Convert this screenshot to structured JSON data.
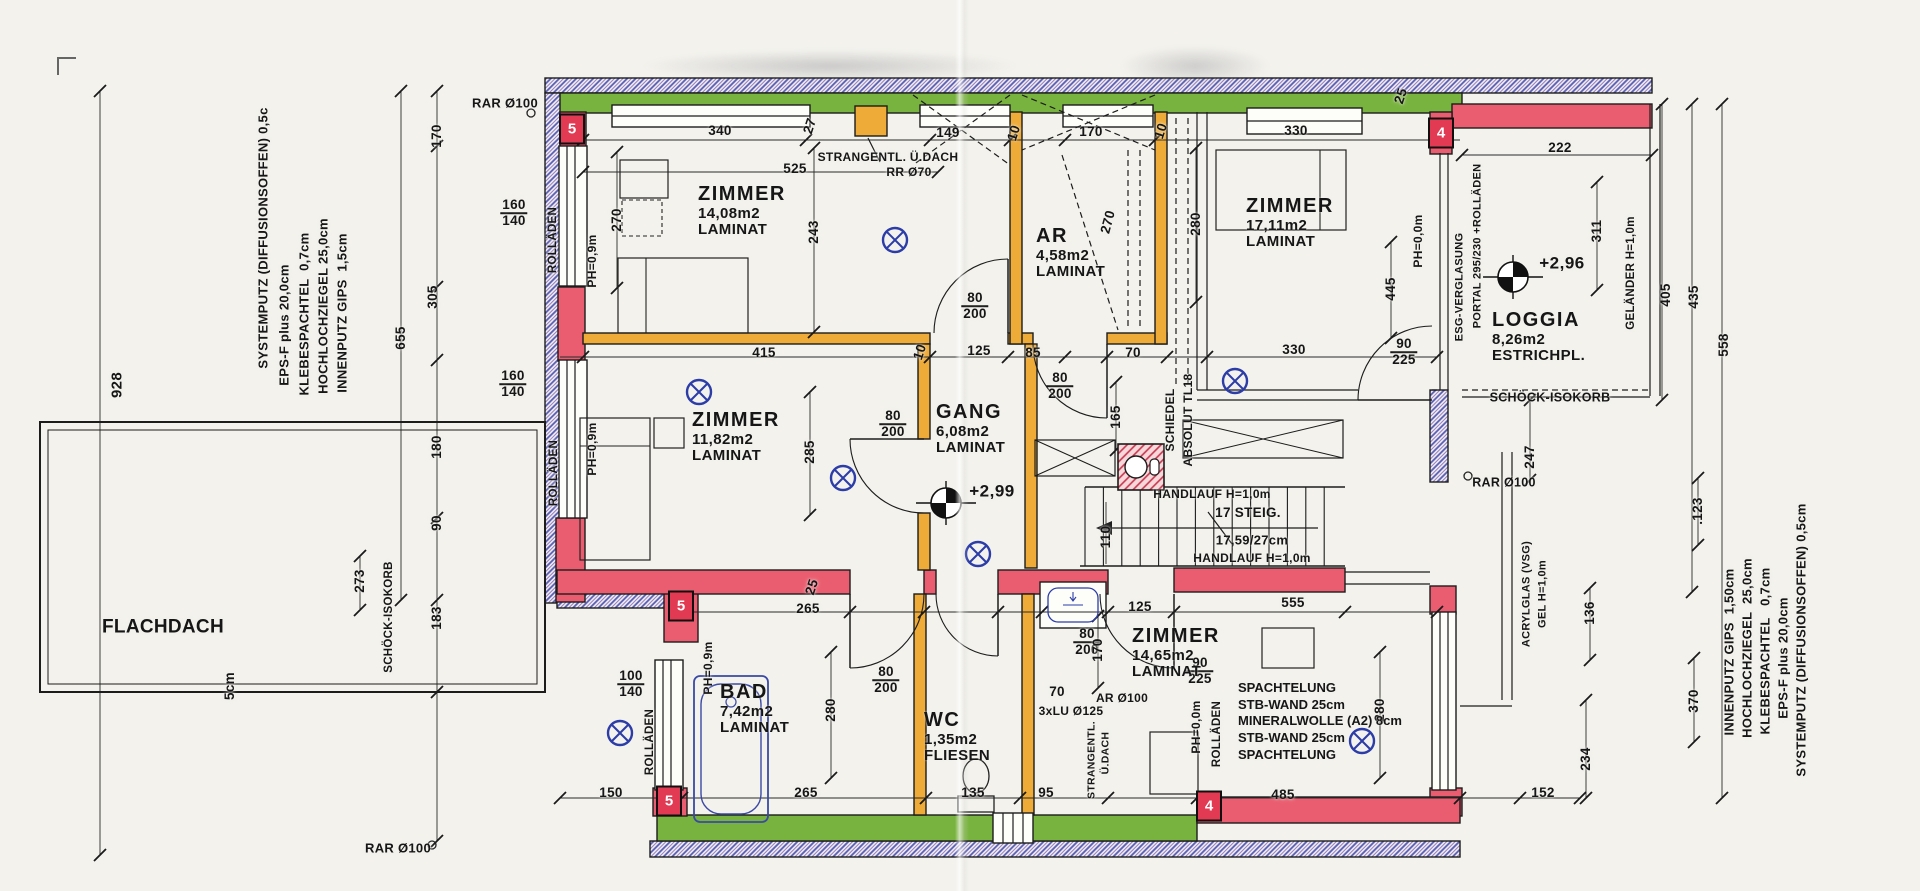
{
  "colors": {
    "paper": "#f3f2ed",
    "exterior_insulation_green": "#79b33f",
    "load_wall_red": "#ea5d70",
    "interior_wall_yellow": "#eeab38",
    "rollladen_hatch_blue": "#5b5bb0",
    "fixture_blue": "#2c3da8",
    "ink": "#161616"
  },
  "rooms": [
    {
      "id": "zimmer-nw",
      "name": "ZIMMER",
      "area": "14,08m2",
      "floor": "LAMINAT",
      "x": 698,
      "y": 184
    },
    {
      "id": "ar",
      "name": "AR",
      "area": "4,58m2",
      "floor": "LAMINAT",
      "x": 1036,
      "y": 226
    },
    {
      "id": "zimmer-ne",
      "name": "ZIMMER",
      "area": "17,11m2",
      "floor": "LAMINAT",
      "x": 1246,
      "y": 196
    },
    {
      "id": "loggia",
      "name": "LOGGIA",
      "area": "8,26m2",
      "floor": "ESTRICHPL.",
      "x": 1492,
      "y": 310
    },
    {
      "id": "zimmer-w",
      "name": "ZIMMER",
      "area": "11,82m2",
      "floor": "LAMINAT",
      "x": 692,
      "y": 410
    },
    {
      "id": "gang",
      "name": "GANG",
      "area": "6,08m2",
      "floor": "LAMINAT",
      "x": 936,
      "y": 402
    },
    {
      "id": "bad",
      "name": "BAD",
      "area": "7,42m2",
      "floor": "LAMINAT",
      "x": 720,
      "y": 682
    },
    {
      "id": "wc",
      "name": "WC",
      "area": "1,35m2",
      "floor": "FLIESEN",
      "x": 924,
      "y": 710
    },
    {
      "id": "zimmer-s",
      "name": "ZIMMER",
      "area": "14,65m2",
      "floor": "LAMINAT",
      "x": 1132,
      "y": 626
    }
  ],
  "levels": [
    {
      "value": "+2,99",
      "x": 992,
      "y": 491,
      "cx": 946,
      "cy": 503
    },
    {
      "value": "+2,96",
      "x": 1562,
      "y": 263,
      "cx": 1513,
      "cy": 277
    }
  ],
  "markers": [
    {
      "t": "5",
      "x": 572,
      "y": 129
    },
    {
      "t": "4",
      "x": 1441,
      "y": 133
    },
    {
      "t": "5",
      "x": 681,
      "y": 606
    },
    {
      "t": "5",
      "x": 669,
      "y": 801
    },
    {
      "t": "4",
      "x": 1209,
      "y": 806
    }
  ],
  "wall_assembly_left": {
    "lines": [
      {
        "t": "SYSTEMPUTZ (DIFFUSIONSOFFEN) 0,5c",
        "x": 263,
        "y": 238,
        "r": -90,
        "s": 13
      },
      {
        "t": "EPS-F plus 20,0cm",
        "x": 284,
        "y": 325,
        "r": -90,
        "s": 13
      },
      {
        "t": "KLEBESPACHTEL  0,7cm",
        "x": 304,
        "y": 314,
        "r": -90,
        "s": 13
      },
      {
        "t": "HOCHLOCHZIEGEL 25,0cm",
        "x": 323,
        "y": 306,
        "r": -90,
        "s": 13
      },
      {
        "t": "INNENPUTZ GIPS  1,5cm",
        "x": 342,
        "y": 313,
        "r": -90,
        "s": 13
      }
    ]
  },
  "wall_assembly_right": {
    "lines": [
      {
        "t": "INNENPUTZ GIPS  1,50cm",
        "x": 1729,
        "y": 652,
        "r": -90,
        "s": 13
      },
      {
        "t": "HOCHLOCHZIEGEL  25,0cm",
        "x": 1747,
        "y": 648,
        "r": -90,
        "s": 13
      },
      {
        "t": "KLEBESPACHTEL   0,7cm",
        "x": 1765,
        "y": 651,
        "r": -90,
        "s": 13
      },
      {
        "t": "EPS-F plus 20,0cm",
        "x": 1783,
        "y": 658,
        "r": -90,
        "s": 13
      },
      {
        "t": "SYSTEMPUTZ (DIFFUSIONSOFFEN) 0,5cm",
        "x": 1801,
        "y": 640,
        "r": -90,
        "s": 13
      }
    ]
  },
  "party_wall": {
    "x": 1238,
    "y": 680,
    "line_height": 16.5,
    "lines": [
      "SPACHTELUNG",
      "STB-WAND 25cm",
      "MINERALWOLLE (A2) 8cm",
      "STB-WAND 25cm",
      "SPACHTELUNG"
    ]
  },
  "dimensions": [
    {
      "t": "340",
      "x": 720,
      "y": 131
    },
    {
      "t": "27",
      "x": 810,
      "y": 126,
      "r": -72
    },
    {
      "t": "149",
      "x": 948,
      "y": 133
    },
    {
      "t": "10",
      "x": 1014,
      "y": 133,
      "r": -72
    },
    {
      "t": "170",
      "x": 1091,
      "y": 132
    },
    {
      "t": "10",
      "x": 1161,
      "y": 131,
      "r": -72
    },
    {
      "t": "330",
      "x": 1296,
      "y": 131
    },
    {
      "t": "25",
      "x": 1401,
      "y": 96,
      "r": -72
    },
    {
      "t": "222",
      "x": 1560,
      "y": 148
    },
    {
      "t": "525",
      "x": 795,
      "y": 169
    },
    {
      "t": "160/140",
      "x": 514,
      "y": 213,
      "f": 1
    },
    {
      "t": "270",
      "x": 617,
      "y": 220,
      "r": -90
    },
    {
      "t": "243",
      "x": 814,
      "y": 232,
      "r": -90
    },
    {
      "t": "270",
      "x": 1108,
      "y": 222,
      "r": -75
    },
    {
      "t": "280",
      "x": 1196,
      "y": 224,
      "r": -90
    },
    {
      "t": "445",
      "x": 1391,
      "y": 289,
      "r": -90
    },
    {
      "t": "311",
      "x": 1597,
      "y": 231,
      "r": -90
    },
    {
      "t": "405",
      "x": 1666,
      "y": 295,
      "r": -90
    },
    {
      "t": "435",
      "x": 1694,
      "y": 297,
      "r": -90
    },
    {
      "t": "558",
      "x": 1724,
      "y": 345,
      "r": -90
    },
    {
      "t": "415",
      "x": 764,
      "y": 353
    },
    {
      "t": "10",
      "x": 920,
      "y": 352,
      "r": -72
    },
    {
      "t": "125",
      "x": 979,
      "y": 351
    },
    {
      "t": "85",
      "x": 1033,
      "y": 353
    },
    {
      "t": "70",
      "x": 1133,
      "y": 353
    },
    {
      "t": "330",
      "x": 1294,
      "y": 350
    },
    {
      "t": "90/225",
      "x": 1404,
      "y": 352,
      "f": 1
    },
    {
      "t": "165",
      "x": 1116,
      "y": 417,
      "r": -90
    },
    {
      "t": "80/200",
      "x": 975,
      "y": 306,
      "f": 1
    },
    {
      "t": "80/200",
      "x": 893,
      "y": 424,
      "f": 1
    },
    {
      "t": "80/200",
      "x": 1060,
      "y": 386,
      "f": 1
    },
    {
      "t": "285",
      "x": 810,
      "y": 452,
      "r": -90
    },
    {
      "t": "110",
      "x": 1106,
      "y": 537,
      "r": -90
    },
    {
      "t": "170",
      "x": 437,
      "y": 136,
      "r": -90
    },
    {
      "t": "305",
      "x": 433,
      "y": 297,
      "r": -90
    },
    {
      "t": "655",
      "x": 401,
      "y": 338,
      "r": -90
    },
    {
      "t": "928",
      "x": 117,
      "y": 385,
      "r": -90,
      "s": 15
    },
    {
      "t": "160/140",
      "x": 513,
      "y": 384,
      "f": 1
    },
    {
      "t": "180",
      "x": 437,
      "y": 447,
      "r": -90
    },
    {
      "t": "90",
      "x": 437,
      "y": 523,
      "r": -90
    },
    {
      "t": "273",
      "x": 360,
      "y": 581,
      "r": -90
    },
    {
      "t": "183",
      "x": 437,
      "y": 618,
      "r": -90
    },
    {
      "t": "5cm",
      "x": 230,
      "y": 686,
      "r": -90
    },
    {
      "t": "265",
      "x": 808,
      "y": 609
    },
    {
      "t": "25",
      "x": 812,
      "y": 587,
      "r": -72
    },
    {
      "t": "125",
      "x": 1140,
      "y": 607
    },
    {
      "t": "555",
      "x": 1293,
      "y": 603
    },
    {
      "t": "80/200",
      "x": 886,
      "y": 680,
      "f": 1
    },
    {
      "t": "80/200",
      "x": 1087,
      "y": 642,
      "f": 1
    },
    {
      "t": "70",
      "x": 1057,
      "y": 692
    },
    {
      "t": "90/225",
      "x": 1200,
      "y": 671,
      "f": 1
    },
    {
      "t": "100/140",
      "x": 631,
      "y": 684,
      "f": 1
    },
    {
      "t": "280",
      "x": 831,
      "y": 710,
      "r": -90
    },
    {
      "t": "170",
      "x": 1098,
      "y": 650,
      "r": -90
    },
    {
      "t": "280",
      "x": 1380,
      "y": 710,
      "r": -90
    },
    {
      "t": "150",
      "x": 611,
      "y": 793
    },
    {
      "t": "265",
      "x": 806,
      "y": 793
    },
    {
      "t": "135",
      "x": 973,
      "y": 793
    },
    {
      "t": "95",
      "x": 1046,
      "y": 793
    },
    {
      "t": "485",
      "x": 1283,
      "y": 795
    },
    {
      "t": "152",
      "x": 1543,
      "y": 793
    },
    {
      "t": "247",
      "x": 1530,
      "y": 457,
      "r": -90
    },
    {
      "t": ".123",
      "x": 1698,
      "y": 511,
      "r": -90
    },
    {
      "t": "136",
      "x": 1590,
      "y": 613,
      "r": -90
    },
    {
      "t": "370",
      "x": 1694,
      "y": 701,
      "r": -90
    },
    {
      "t": "234",
      "x": 1586,
      "y": 759,
      "r": -90
    }
  ],
  "annotations": [
    {
      "t": "RAR Ø100",
      "x": 505,
      "y": 103,
      "s": 13,
      "n": "vent-note"
    },
    {
      "t": "STRANGENTL. Ü.DACH",
      "x": 888,
      "y": 157,
      "s": 12,
      "n": "vent-note"
    },
    {
      "t": "RR Ø70",
      "x": 909,
      "y": 172,
      "s": 12,
      "n": "vent-note"
    },
    {
      "t": "SCHIEDEL",
      "x": 1170,
      "y": 420,
      "r": -90,
      "s": 12,
      "n": "chimney-note"
    },
    {
      "t": "ABSOLUT TL18",
      "x": 1188,
      "y": 420,
      "r": -90,
      "s": 12,
      "n": "chimney-note"
    },
    {
      "t": "HANDLAUF H=1,0m",
      "x": 1212,
      "y": 494,
      "s": 12,
      "n": "stair-note"
    },
    {
      "t": "17 STEIG.",
      "x": 1248,
      "y": 513,
      "s": 13.5,
      "n": "stair-note"
    },
    {
      "t": "17,59/27cm",
      "x": 1252,
      "y": 540,
      "s": 13,
      "n": "stair-note"
    },
    {
      "t": "HANDLAUF H=1,0m",
      "x": 1252,
      "y": 558,
      "s": 12,
      "n": "stair-note"
    },
    {
      "t": "ROLLÄDEN",
      "x": 554,
      "y": 240,
      "r": -90,
      "s": 11.5,
      "n": "shutter-note"
    },
    {
      "t": "PH=0,9m",
      "x": 592,
      "y": 261,
      "r": -90,
      "s": 12,
      "n": "parapet-note"
    },
    {
      "t": "PH=0,9m",
      "x": 592,
      "y": 449,
      "r": -90,
      "s": 12,
      "n": "parapet-note"
    },
    {
      "t": "ROLLÄDEN",
      "x": 555,
      "y": 473,
      "r": -90,
      "s": 11.5,
      "n": "shutter-note"
    },
    {
      "t": "SCHÖCK-ISOKORB",
      "x": 390,
      "y": 617,
      "r": -90,
      "s": 11.5,
      "n": "isokorb-note"
    },
    {
      "t": "ROLLÄDEN",
      "x": 651,
      "y": 742,
      "r": -90,
      "s": 11.5,
      "n": "shutter-note"
    },
    {
      "t": "PH=0,9m",
      "x": 708,
      "y": 668,
      "r": -90,
      "s": 12,
      "n": "parapet-note"
    },
    {
      "t": "PH=0,0m",
      "x": 1418,
      "y": 241,
      "r": -90,
      "s": 12,
      "n": "parapet-note"
    },
    {
      "t": "ESG-VERGLASUNG",
      "x": 1460,
      "y": 287,
      "r": -90,
      "s": 11,
      "n": "glazing-note"
    },
    {
      "t": "PORTAL 295/230 +ROLLÄDEN",
      "x": 1478,
      "y": 246,
      "r": -90,
      "s": 11,
      "n": "portal-note"
    },
    {
      "t": "GELÄNDER H=1,0m",
      "x": 1632,
      "y": 273,
      "r": -90,
      "s": 11.5,
      "n": "railing-note"
    },
    {
      "t": "SCHÖCK-ISOKORB",
      "x": 1550,
      "y": 398,
      "s": 12.5,
      "n": "isokorb-note"
    },
    {
      "t": "RAR Ø100",
      "x": 1504,
      "y": 483,
      "s": 12.5,
      "n": "vent-note"
    },
    {
      "t": "ACRYLGLAS (VSG)",
      "x": 1527,
      "y": 594,
      "r": -90,
      "s": 11,
      "n": "railing-note"
    },
    {
      "t": "GEL H=1,0m",
      "x": 1543,
      "y": 594,
      "r": -90,
      "s": 11,
      "n": "railing-note"
    },
    {
      "t": "PH=0,0m",
      "x": 1196,
      "y": 727,
      "r": -90,
      "s": 12,
      "n": "parapet-note"
    },
    {
      "t": "ROLLÄDEN",
      "x": 1218,
      "y": 734,
      "r": -90,
      "s": 11.5,
      "n": "shutter-note"
    },
    {
      "t": "3xLU Ø125",
      "x": 1071,
      "y": 711,
      "s": 12,
      "n": "vent-note"
    },
    {
      "t": "AR Ø100",
      "x": 1122,
      "y": 698,
      "s": 12,
      "n": "vent-note"
    },
    {
      "t": "STRANGENTL.",
      "x": 1092,
      "y": 760,
      "r": -90,
      "s": 10.5,
      "n": "vent-note"
    },
    {
      "t": "Ü.DACH",
      "x": 1106,
      "y": 753,
      "r": -90,
      "s": 10.5,
      "n": "vent-note"
    },
    {
      "t": "FLACHDACH",
      "x": 163,
      "y": 627,
      "s": 19,
      "n": "flat-roof-label"
    },
    {
      "t": "RAR Ø100",
      "x": 398,
      "y": 848,
      "s": 13,
      "n": "vent-note"
    }
  ]
}
